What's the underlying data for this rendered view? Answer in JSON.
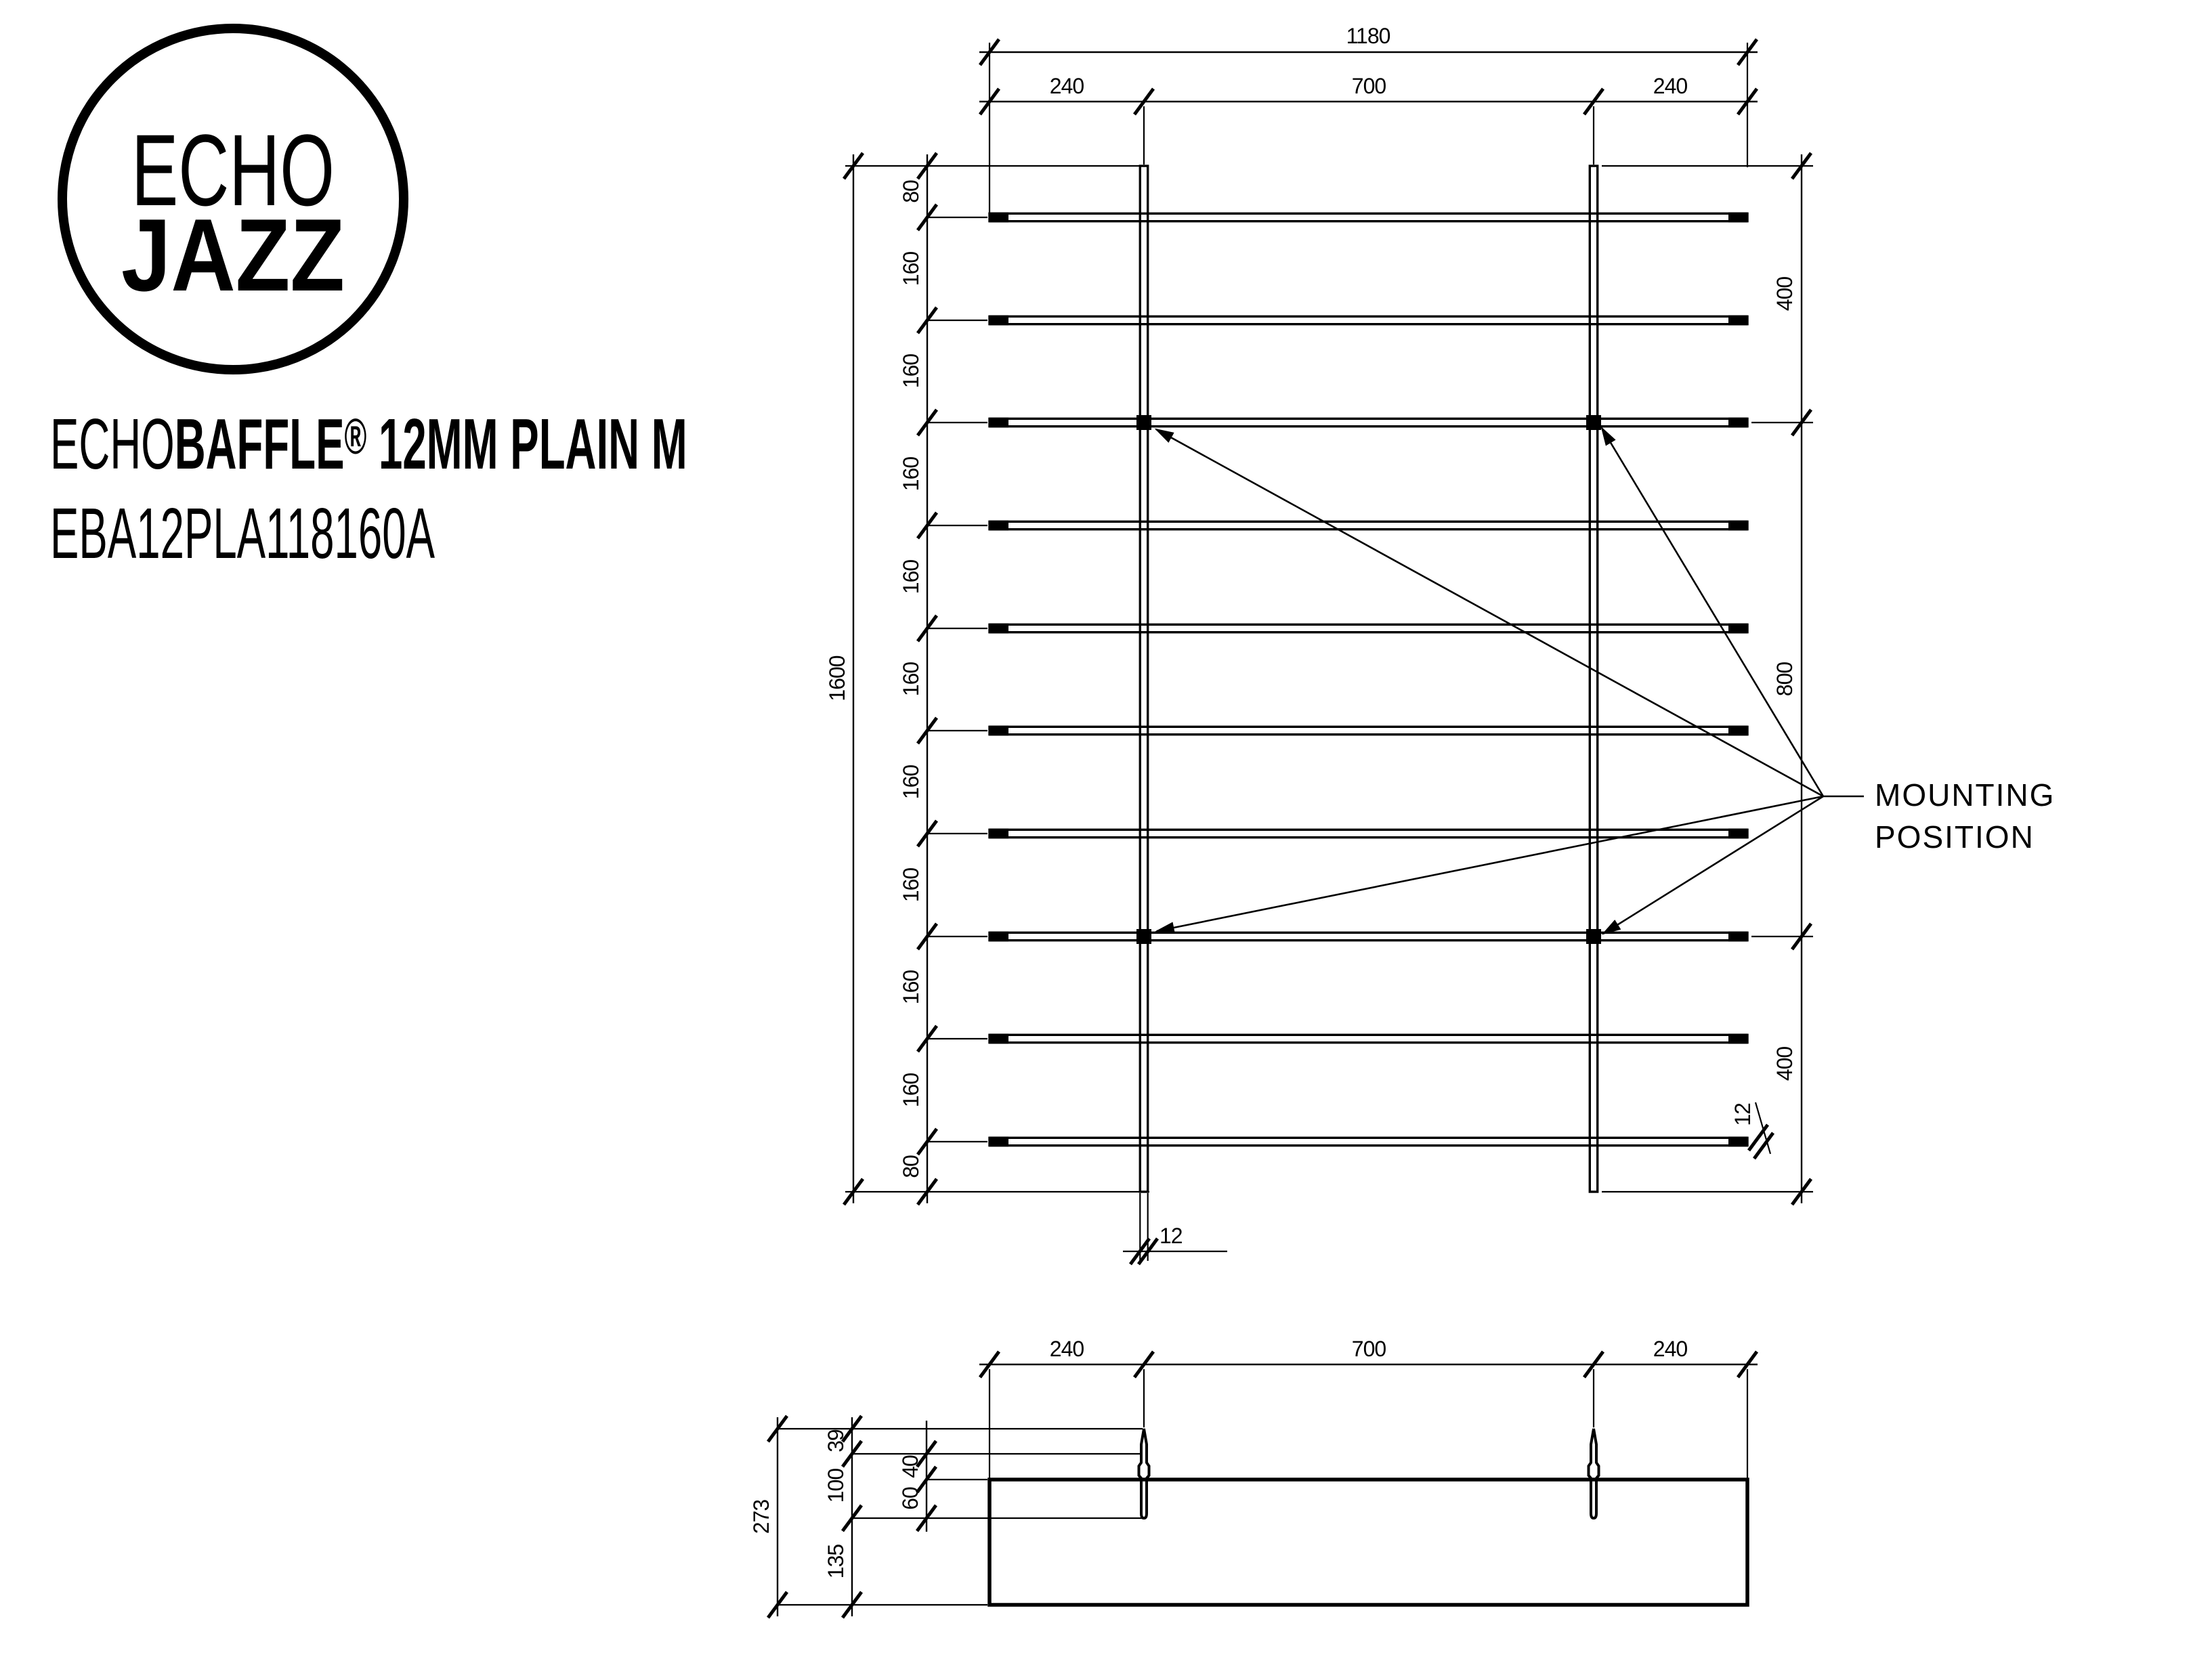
{
  "brand": {
    "line1": "ECHO",
    "line2": "JAZZ"
  },
  "product": {
    "series": "ECHO",
    "family": "BAFFLE",
    "reg_mark": "®",
    "variant": " 12MM PLAIN M",
    "code": "EBA12PLA118160A"
  },
  "front_view": {
    "width_total": "1180",
    "width_segments": [
      "240",
      "700",
      "240"
    ],
    "height_total": "1600",
    "height_segments": [
      "80",
      "160",
      "160",
      "160",
      "160",
      "160",
      "160",
      "160",
      "160",
      "160",
      "80"
    ],
    "right_segments": [
      "400",
      "800",
      "400"
    ],
    "rail_thickness": "12",
    "slat_thickness": "12"
  },
  "side_view": {
    "width_segments": [
      "240",
      "700",
      "240"
    ],
    "depth_total": "273",
    "left_segments": [
      "39",
      "100",
      "135"
    ],
    "inner_segments": [
      "40",
      "60"
    ]
  },
  "annotations": {
    "mounting_line1": "MOUNTING",
    "mounting_line2": "POSITION"
  },
  "colors": {
    "ink": "#000000",
    "background": "#ffffff"
  }
}
